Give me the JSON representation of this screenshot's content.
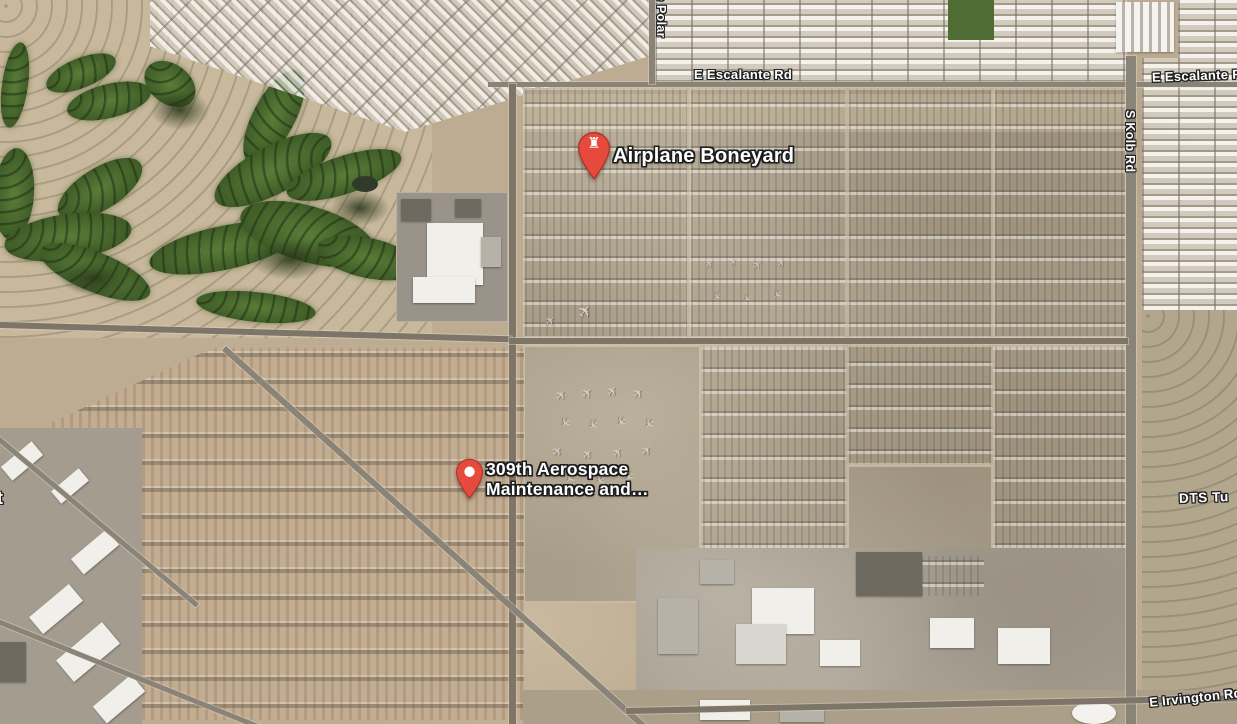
{
  "map": {
    "view_type": "satellite",
    "markers": [
      {
        "title": "Airplane Boneyard",
        "icon": "attraction-pin",
        "glyph": "♜",
        "pin_color": "#E64A3C"
      },
      {
        "title_line1": "309th Aerospace",
        "title_line2": "Maintenance and…",
        "icon": "place-pin",
        "pin_color": "#E64A3C"
      }
    ],
    "road_labels": {
      "escalante_center": "E Escalante Rd",
      "escalante_right": "E Escalante Rd",
      "kolb": "S Kolb Rd",
      "polar": "e Polar",
      "irvington": "E Irvington Rd",
      "dts": "DTS Tu",
      "left_partial": "t"
    },
    "palette": {
      "marker_red": "#E64A3C",
      "label_text": "#FFFFFF",
      "label_outline": "#1F1F1F",
      "desert_tan": "#BDAC91",
      "boneyard_gray": "#A89D89",
      "rows_pink_tan": "#C3AC90",
      "golf_green": "#46662C",
      "road_gray": "#8A8377",
      "residential_light": "#D6D1C8"
    },
    "decorations": {
      "aircraft_glyph": "✈"
    }
  }
}
